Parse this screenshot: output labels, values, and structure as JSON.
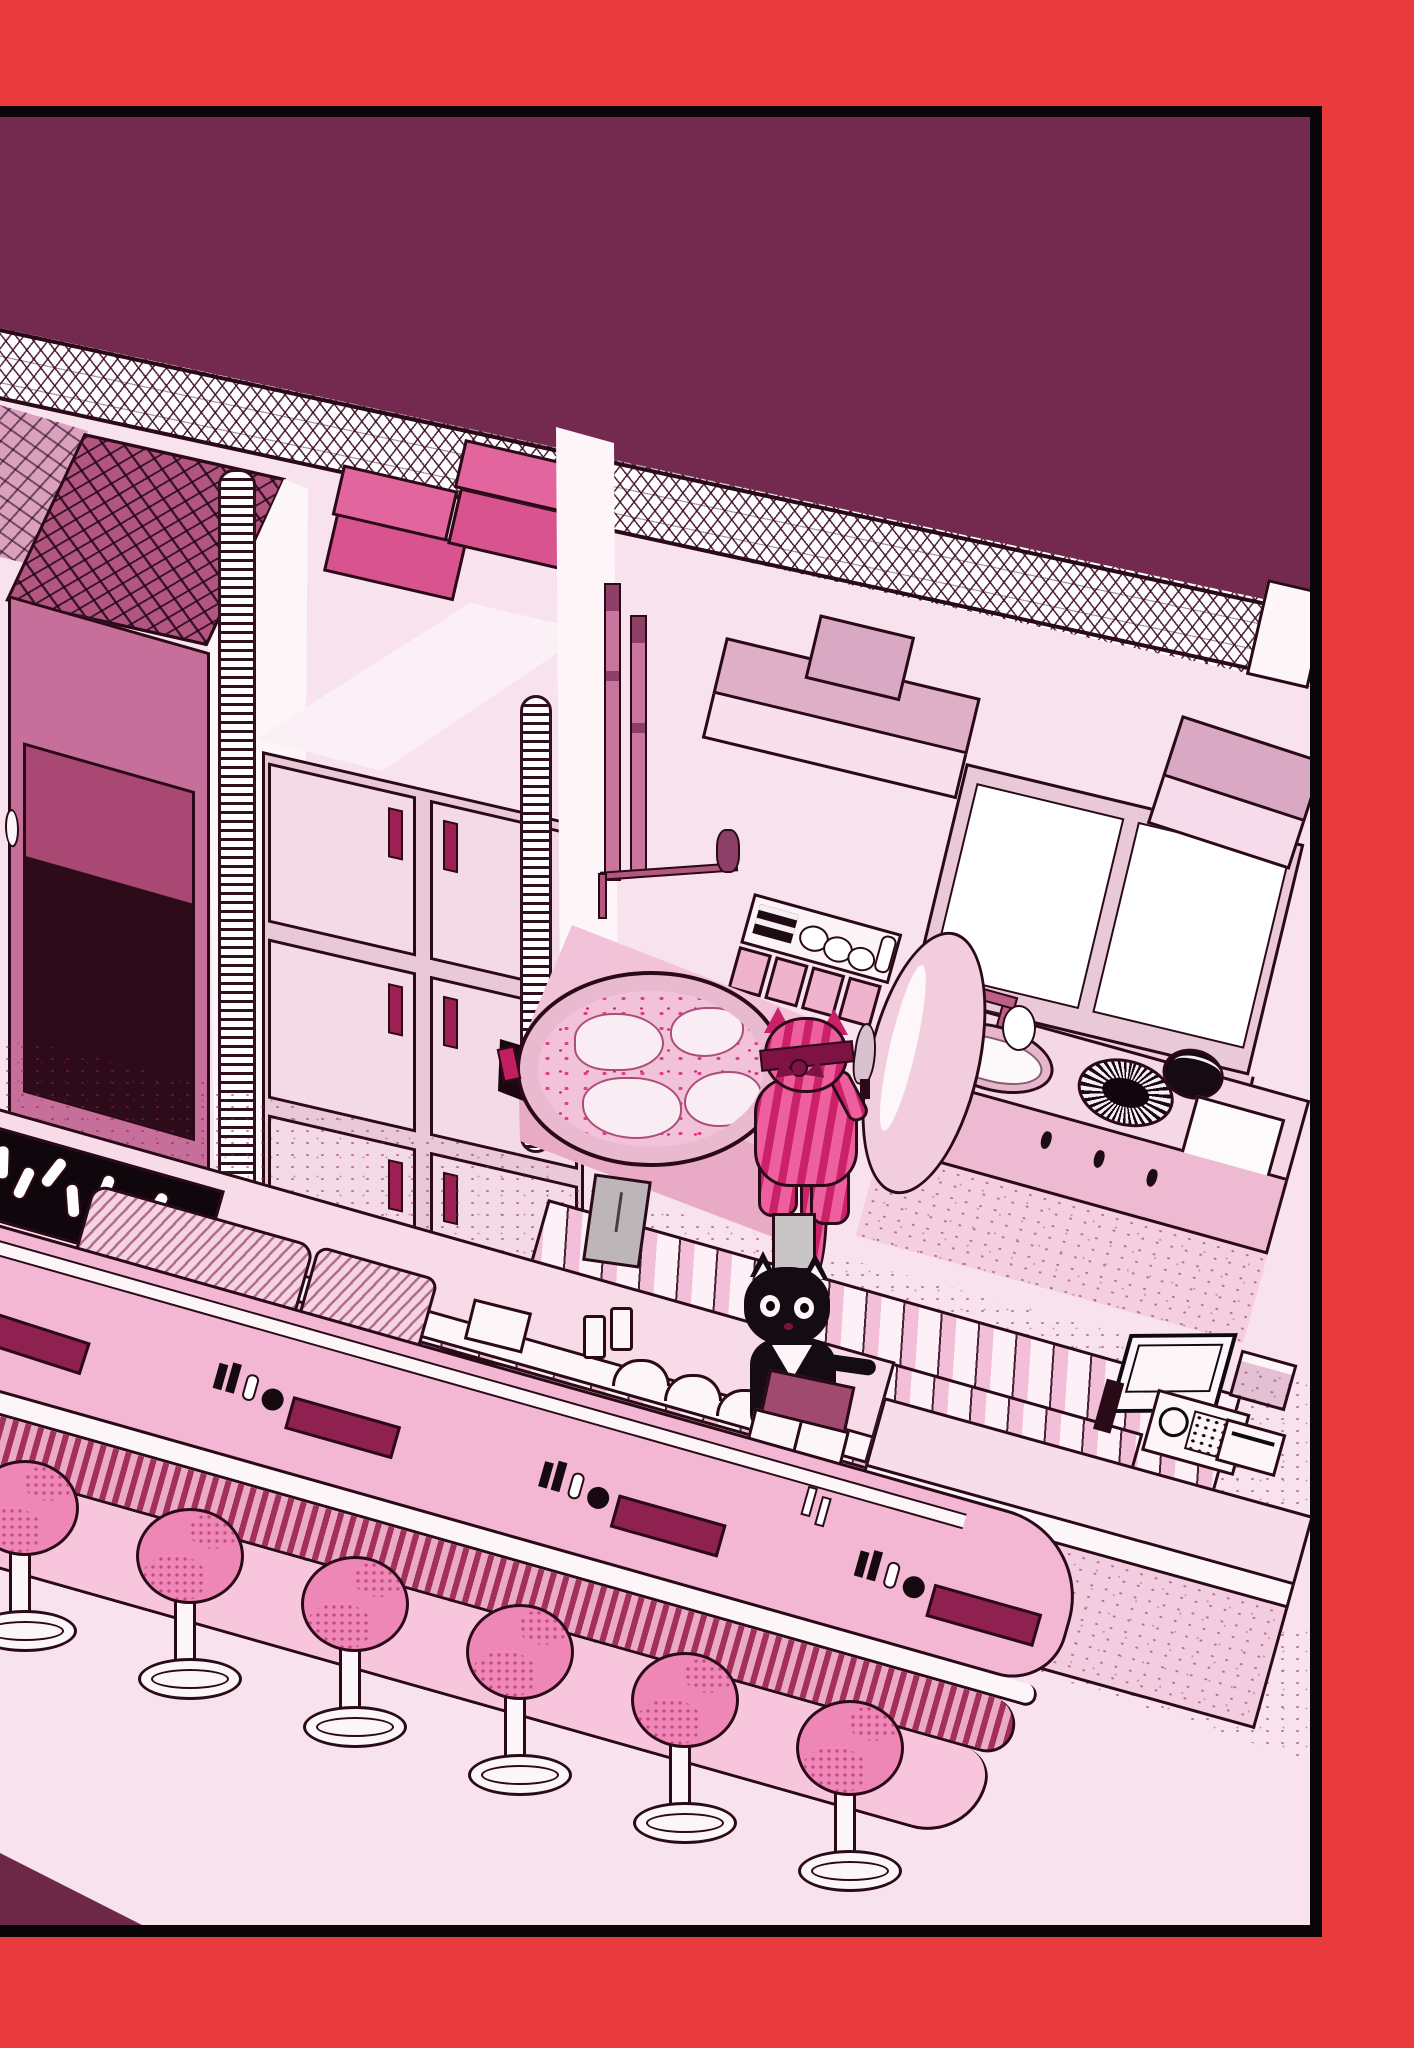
{
  "scene": {
    "kind": "illustration",
    "description": "Isometric comic-style illustration of a pink ramen-diner kitchen framed by a red page border. A pink striped cat cook chops at a prep station and a black waiter cat holds an order book at the counter.",
    "palette_note": "monochrome pink/magenta line art inside a bright red frame"
  },
  "colors": {
    "frame_red": "#e93a3e",
    "frame_line": "#0b0508",
    "wall_maroon": "#74294f",
    "wall_light": "#f8e2ed",
    "dark_line": "#2b0a18",
    "roof_base": "#b25580",
    "fridge_front": "#c66f9a",
    "fridge_inset": "#a84873",
    "fridge_dark": "#2d0b19",
    "locker_body": "#e9c8d8",
    "locker_door": "#f3dae6",
    "handle": "#9c2053",
    "box_a": "#e3659d",
    "box_b": "#d9538f",
    "bar_top": "#f4b7d3",
    "bar_front": "#f7c6dc",
    "fringe_dark": "#a23059",
    "fringe_light": "#e9a9c7",
    "stool": "#ee86b6",
    "stool_dot": "#c74a88",
    "tile_bg": "#fbf3f7",
    "slat_a": "#f3bed7",
    "slat_b": "#fdf1f7",
    "white": "#fdf6f9",
    "broth": "#f2c3d8",
    "broth_dot": "#e13d8c",
    "cat_stripe_a": "#cb2168",
    "cat_stripe_b": "#ee5fa0",
    "bandana": "#7e1243",
    "cat_black": "#140c12",
    "book": "#a04a70",
    "maroon_triangle": "#6d2848"
  },
  "inventory": {
    "stool_count": 6,
    "locker_door_count": 6,
    "stacked_box_count": 4,
    "condiment_set_count": 4,
    "coil_column_count": 2,
    "duckboard_count": 2,
    "cats": [
      {
        "id": "pink-striped-cat",
        "pose": "seen from behind, bandana tied on head, holding a knife at the prep pot"
      },
      {
        "id": "black-cat",
        "pose": "facing viewer, white bib, holding a dark pink order book over an open notebook"
      }
    ],
    "appliances": [
      "refrigerator",
      "locker-cabinet",
      "range-hood",
      "second-range-hood",
      "window",
      "soup-pot",
      "pot-lid",
      "sink-basin",
      "wok-burner",
      "kettle-pot",
      "cutting-board",
      "cash-register",
      "bottle-crate",
      "drying-mats",
      "bar-counter",
      "back-counter",
      "register-counter"
    ]
  }
}
